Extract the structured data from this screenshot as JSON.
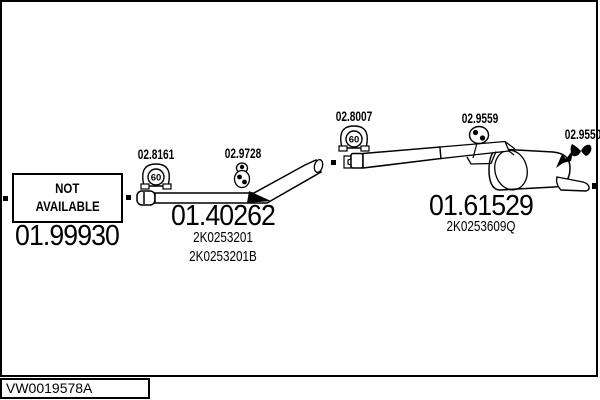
{
  "parts": {
    "left": {
      "status_line1": "NOT",
      "status_line2": "AVAILABLE",
      "number": "01.99930"
    },
    "middle": {
      "number": "01.40262",
      "oem": [
        "2K0253201",
        "2K0253201B"
      ]
    },
    "right": {
      "number": "01.61529",
      "oem": [
        "2K0253609Q"
      ]
    }
  },
  "fittings": {
    "clamp1": {
      "label": "02.8161",
      "diameter": "60"
    },
    "hanger1": {
      "label": "02.9728"
    },
    "clamp2": {
      "label": "02.8007",
      "diameter": "60"
    },
    "hanger2": {
      "label": "02.9559"
    },
    "hanger3": {
      "label": "02.9550"
    }
  },
  "footer": {
    "reference": "VW0019578A"
  },
  "colors": {
    "ink": "#000000",
    "background": "#ffffff"
  }
}
